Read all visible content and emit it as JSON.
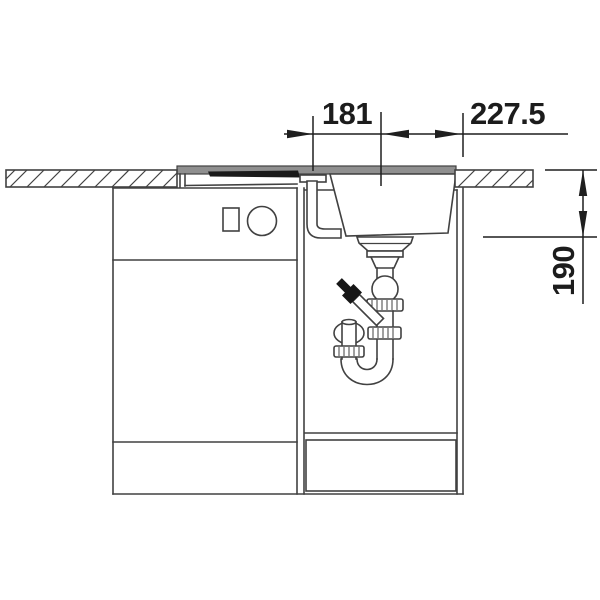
{
  "dimensions": {
    "offset_label": "181",
    "cutout_label": "227.5",
    "depth_label": "190"
  },
  "colors": {
    "line": "#414141",
    "dimension": "#1f1f1f",
    "sink_rim": "#8f8f8f",
    "drainer_groove": "#1a1a1a",
    "fitting_black": "#161616",
    "background": "#ffffff"
  }
}
